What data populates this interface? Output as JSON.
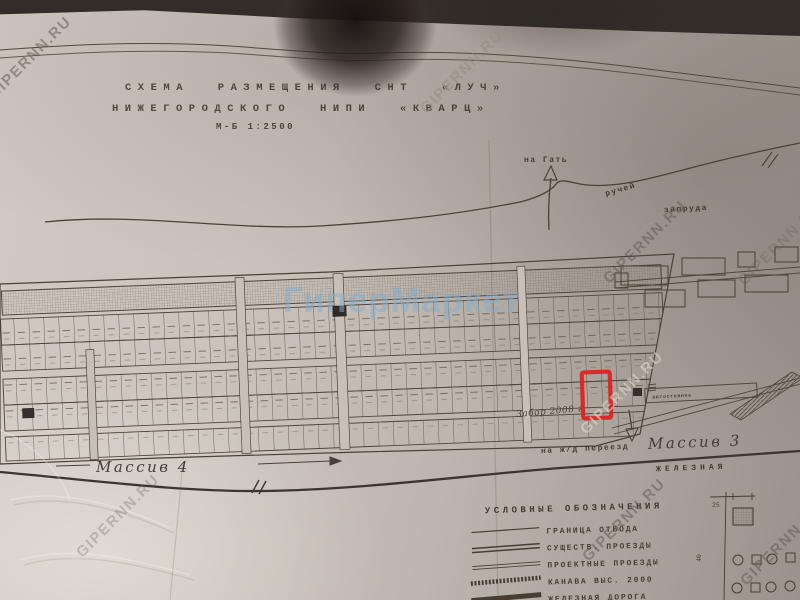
{
  "source": {
    "watermark": "GIPERNN.RU",
    "watermark_center": "ГиперМаркет"
  },
  "title": {
    "line1": "СХЕМА РАЗМЕЩЕНИЯ СНТ «ЛУЧ»",
    "line2": "НИЖЕГОРОДСКОГО НИПИ «КВАРЦ»",
    "scale": "М-Б 1:2500"
  },
  "labels": {
    "to_gat": "на Гать",
    "stream": "ручей",
    "pond_area": "запруда",
    "fence_note": "Забор 2008 г.",
    "to_crossing": "на ж/д переезд",
    "massiv3": "Массив 3",
    "massiv4": "Массив 4",
    "railway_word": "ЖЕЛЕЗНАЯ",
    "parking": "автостоянка"
  },
  "legend": {
    "header": "УСЛОВНЫЕ ОБОЗНАЧЕНИЯ",
    "items": [
      {
        "label": "ГРАНИЦА ОТВОДА"
      },
      {
        "label": "СУЩЕСТВ. ПРОЕЗДЫ"
      },
      {
        "label": "ПРОЕКТНЫЕ ПРОЕЗДЫ"
      },
      {
        "label": "КАНАВА ВЫС. 2000"
      },
      {
        "label": "ЖЕЛЕЗНАЯ ДОРОГА"
      }
    ]
  },
  "inset": {
    "dim_top": "25",
    "dim_left": "40"
  },
  "highlight": {
    "color": "#dd2020"
  }
}
